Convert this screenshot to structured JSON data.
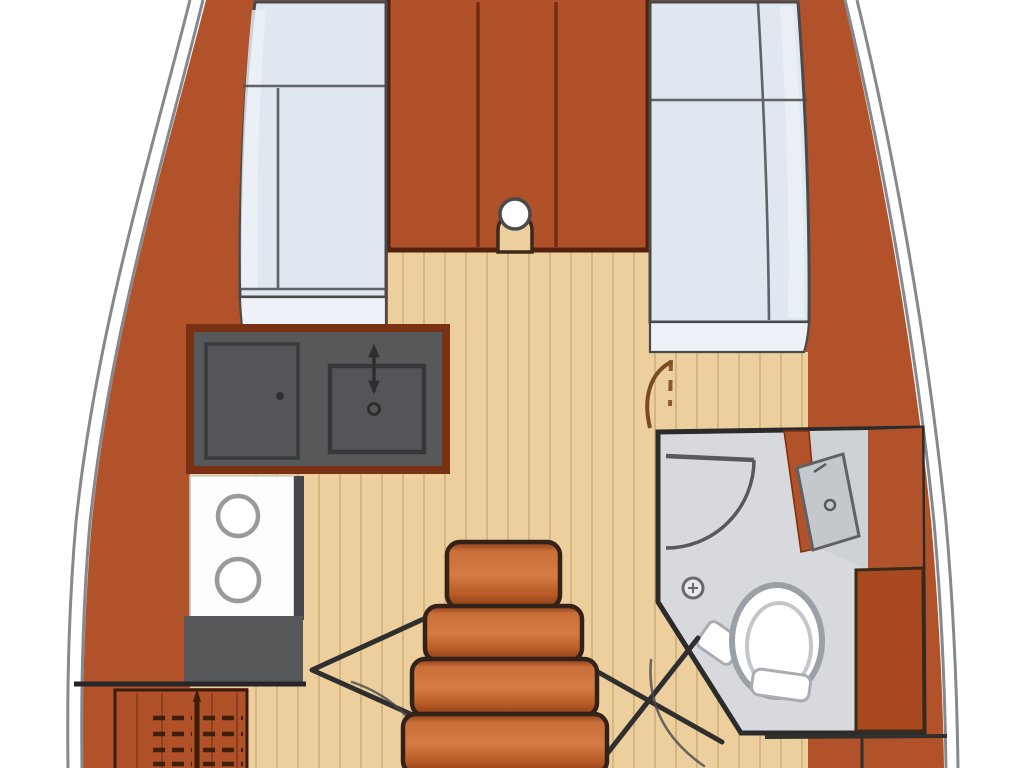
{
  "diagram": {
    "type": "sailboat-interior-floorplan-top-view",
    "companionway_steps": 4,
    "stove_burners": 2,
    "settee_count": 2
  },
  "colors": {
    "background": "#ffffff",
    "hull_line": "#85898d",
    "hull_band": "#b1522a",
    "cabinet": "#b0512a",
    "cabinet_dark": "#a8491f",
    "cabinet_outline": "#52220e",
    "floor": "#eccf9d",
    "floor_line": "#c3a06b",
    "cushion": "#dfe7f1",
    "cushion_light": "#eef2f8",
    "cushion_outline": "#4a4a4a",
    "counter": "#57585a",
    "counter_inner": "#545558",
    "counter_outline": "#36373a",
    "counter_border": "#7a3013",
    "appliance_white": "#fdfdfd",
    "head_floor": "#d7d9dc",
    "head_outline": "#2b2b2b",
    "fixture_gray": "#9aa0a6",
    "fixture_light": "#cfd2d5",
    "step_mid": "#d47c44",
    "step_edge": "#8a3c16",
    "step_outline": "#33221a",
    "door_line": "#2f2f2f",
    "door_dash": "#8a5a2a",
    "wood_icon": "#3f1f08",
    "bulkhead_line": "#26262a"
  }
}
